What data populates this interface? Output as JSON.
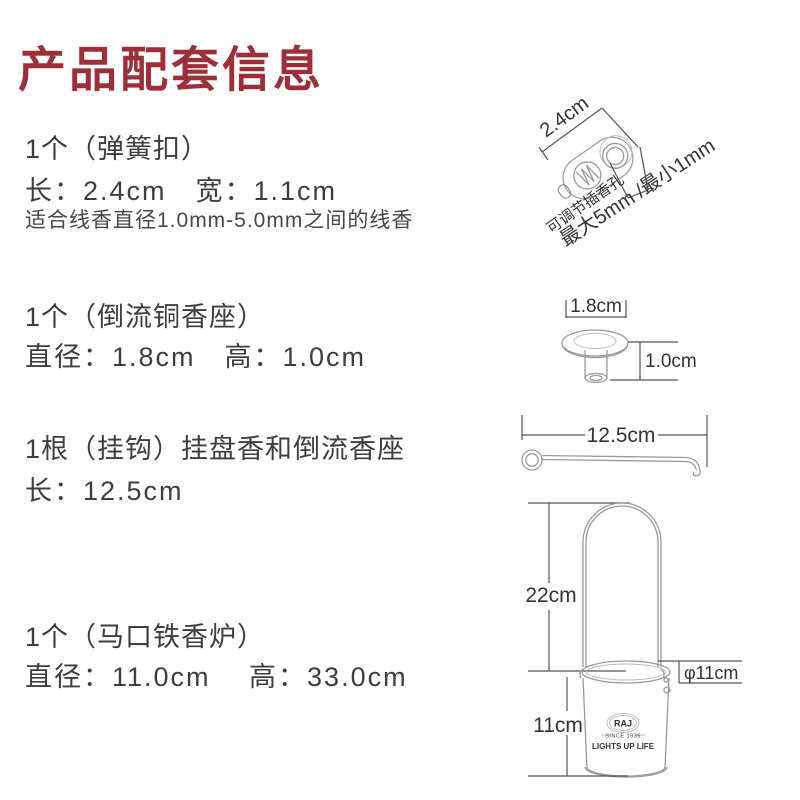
{
  "colors": {
    "title": "#9E2F38",
    "body-text": "#3E3E3E",
    "diagram-line": "#555555",
    "drawing-stroke": "#9A9A9A",
    "diagram-text": "#333333"
  },
  "header": {
    "title": "产品配套信息"
  },
  "items": [
    {
      "name": "1个（弹簧扣）",
      "dims": "长：2.4cm　宽：1.1cm",
      "note": "适合线香直径1.0mm-5.0mm之间的线香"
    },
    {
      "name": "1个（倒流铜香座）",
      "dims": "直径：1.8cm　高：1.0cm"
    },
    {
      "name": "1根（挂钩）挂盘香和倒流香座",
      "dims": "长：12.5cm"
    },
    {
      "name": "1个（马口铁香炉）",
      "dims": "直径：11.0cm　 高：33.0cm"
    }
  ],
  "diagrams": {
    "spring_clasp": {
      "length": "2.4cm",
      "hole_note": "可调节插香孔",
      "hole_range": "最大5mm /最小1mm"
    },
    "copper_seat": {
      "diameter": "1.8cm",
      "height": "1.0cm"
    },
    "hook": {
      "length": "12.5cm"
    },
    "burner": {
      "handle_height": "22cm",
      "diameter": "φ11cm",
      "body_height": "11cm",
      "logo_name": "RAJ",
      "logo_since": "SINCE 1935",
      "logo_slogan": "LIGHTS UP LIFE"
    }
  }
}
